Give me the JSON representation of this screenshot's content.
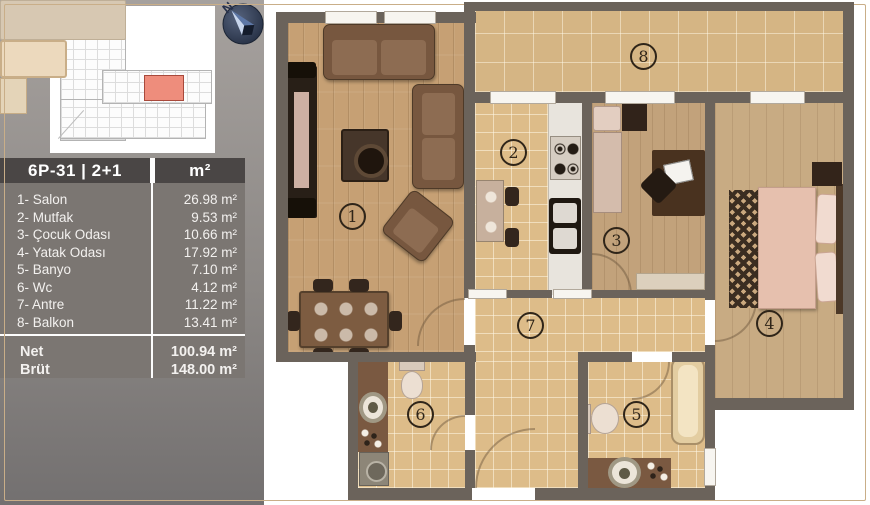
{
  "sidebar": {
    "header": {
      "title": "6P-31 | 2+1",
      "unit": "m²"
    },
    "rooms": [
      {
        "num": "1",
        "label": "1- Salon",
        "area": "26.98 m²"
      },
      {
        "num": "2",
        "label": "2- Mutfak",
        "area": "9.53 m²"
      },
      {
        "num": "3",
        "label": "3- Çocuk Odası",
        "area": "10.66 m²"
      },
      {
        "num": "4",
        "label": "4- Yatak Odası",
        "area": "17.92 m²"
      },
      {
        "num": "5",
        "label": "5- Banyo",
        "area": "7.10 m²"
      },
      {
        "num": "6",
        "label": "6- Wc",
        "area": "4.12 m²"
      },
      {
        "num": "7",
        "label": "7- Antre",
        "area": "11.22 m²"
      },
      {
        "num": "8",
        "label": "8- Balkon",
        "area": "13.41 m²"
      }
    ],
    "totals": [
      {
        "label": "Net",
        "value": "100.94 m²"
      },
      {
        "label": "Brüt",
        "value": "148.00 m²"
      }
    ]
  },
  "compass": {
    "label": "N"
  },
  "plan": {
    "markers": [
      "1",
      "2",
      "3",
      "4",
      "5",
      "6",
      "7",
      "8"
    ]
  },
  "colors": {
    "panel_body": "#7b7672",
    "panel_header": "#4a4645",
    "wall": "#6b635b",
    "wood_floor": "#c6a074",
    "tile_floor": "#ddbc89",
    "highlight_unit": "#ee8d7c",
    "marker_ink": "#2f2519"
  }
}
